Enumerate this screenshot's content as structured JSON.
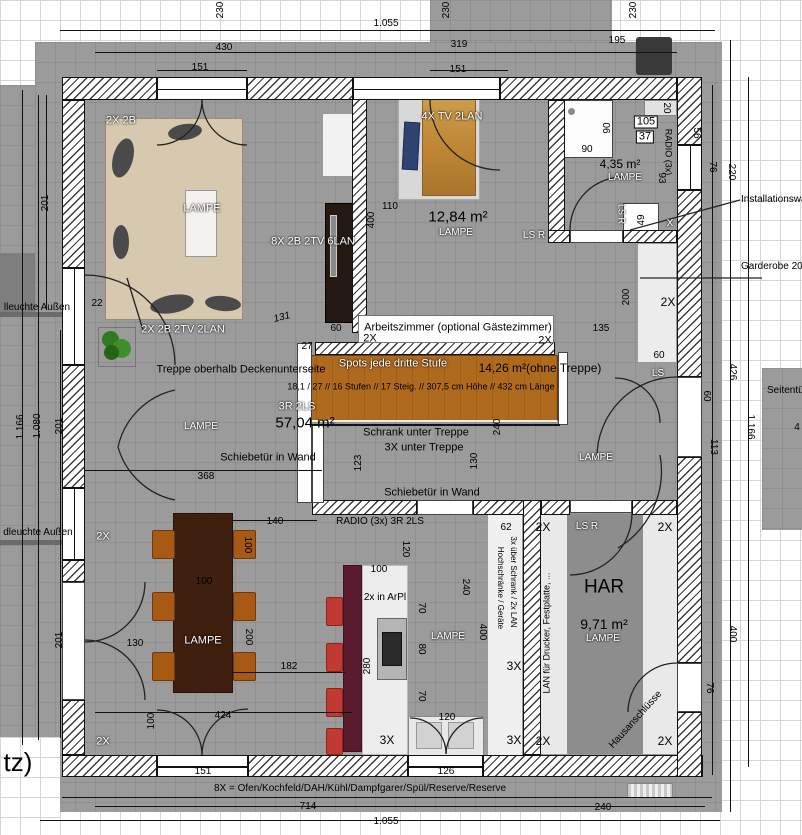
{
  "colors": {
    "ground": "#9b9b9b",
    "wallhatch": "#3a3a3a",
    "stair": "#b06a1e",
    "island": "#5a1b2f",
    "wood": "#bf8534",
    "sofa": "#d6c9b0",
    "table": "#3f1f0d",
    "chair": "#a85a14",
    "stool": "#c13a31",
    "pillow": "#2e4370"
  },
  "plan": {
    "annotations": [
      {
        "t": "1.055",
        "x": 386,
        "y": 24
      },
      {
        "t": "430",
        "x": 224,
        "y": 48
      },
      {
        "t": "151",
        "x": 200,
        "y": 68
      },
      {
        "t": "319",
        "x": 459,
        "y": 45
      },
      {
        "t": "151",
        "x": 458,
        "y": 70
      },
      {
        "t": "195",
        "x": 617,
        "y": 41
      },
      {
        "t": "230",
        "x": 221,
        "y": 10,
        "r": -90
      },
      {
        "t": "230",
        "x": 447,
        "y": 10,
        "r": -90
      },
      {
        "t": "230",
        "x": 634,
        "y": 10,
        "r": -90
      },
      {
        "t": "201",
        "x": 46,
        "y": 203,
        "r": -90
      },
      {
        "t": "1.166",
        "x": 21,
        "y": 427,
        "r": -90
      },
      {
        "t": "1.080",
        "x": 38,
        "y": 426,
        "r": -90
      },
      {
        "t": "201",
        "x": 60,
        "y": 426,
        "r": -90
      },
      {
        "t": "201",
        "x": 60,
        "y": 640,
        "r": -90
      },
      {
        "t": "22",
        "x": 97,
        "y": 304
      },
      {
        "t": "20",
        "x": 666,
        "y": 108,
        "r": 90
      },
      {
        "t": "105",
        "x": 646,
        "y": 122,
        "s": 11,
        "bg": 1
      },
      {
        "t": "37",
        "x": 645,
        "y": 137,
        "s": 11,
        "bg": 1
      },
      {
        "t": "RADIO (3x)",
        "x": 668,
        "y": 152,
        "r": 90,
        "s": 9
      },
      {
        "t": "56",
        "x": 696,
        "y": 133,
        "r": 90
      },
      {
        "t": "93",
        "x": 661,
        "y": 178,
        "r": 90
      },
      {
        "t": "76",
        "x": 712,
        "y": 167,
        "r": 90
      },
      {
        "t": "220",
        "x": 731,
        "y": 172,
        "r": 90
      },
      {
        "t": "49",
        "x": 642,
        "y": 220,
        "r": -90
      },
      {
        "t": "X",
        "x": 670,
        "y": 224,
        "c": "w"
      },
      {
        "t": "60",
        "x": 659,
        "y": 356
      },
      {
        "t": "200",
        "x": 627,
        "y": 297,
        "r": -90
      },
      {
        "t": "135",
        "x": 601,
        "y": 329
      },
      {
        "t": "426",
        "x": 732,
        "y": 372,
        "r": 90
      },
      {
        "t": "60",
        "x": 706,
        "y": 396,
        "r": 90
      },
      {
        "t": "113",
        "x": 713,
        "y": 447,
        "r": 90
      },
      {
        "t": "1.166",
        "x": 750,
        "y": 427,
        "r": 90
      },
      {
        "t": "400",
        "x": 732,
        "y": 634,
        "r": 90
      },
      {
        "t": "76",
        "x": 709,
        "y": 688,
        "r": 90
      },
      {
        "t": "240",
        "x": 603,
        "y": 808
      },
      {
        "t": "151",
        "x": 203,
        "y": 772
      },
      {
        "t": "126",
        "x": 446,
        "y": 772
      },
      {
        "t": "714",
        "x": 308,
        "y": 807
      },
      {
        "t": "1.055",
        "x": 386,
        "y": 822
      },
      {
        "t": "131",
        "x": 282,
        "y": 318,
        "r": -15,
        "i": 1
      },
      {
        "t": "60",
        "x": 336,
        "y": 329
      },
      {
        "t": "27",
        "x": 307,
        "y": 347
      },
      {
        "t": "110",
        "x": 390,
        "y": 207
      },
      {
        "t": "400",
        "x": 372,
        "y": 220,
        "r": -90
      },
      {
        "t": "90",
        "x": 587,
        "y": 150
      },
      {
        "t": "90",
        "x": 608,
        "y": 128,
        "r": -90
      },
      {
        "t": "368",
        "x": 206,
        "y": 477
      },
      {
        "t": "123",
        "x": 359,
        "y": 463,
        "r": -90
      },
      {
        "t": "130",
        "x": 475,
        "y": 461,
        "r": -90
      },
      {
        "t": "240",
        "x": 498,
        "y": 427,
        "r": -90
      },
      {
        "t": "120",
        "x": 405,
        "y": 549,
        "r": 90
      },
      {
        "t": "100",
        "x": 379,
        "y": 570
      },
      {
        "t": "70",
        "x": 421,
        "y": 608,
        "r": 90
      },
      {
        "t": "80",
        "x": 421,
        "y": 649,
        "r": 90
      },
      {
        "t": "70",
        "x": 421,
        "y": 696,
        "r": 90
      },
      {
        "t": "280",
        "x": 368,
        "y": 666,
        "r": -90
      },
      {
        "t": "240",
        "x": 465,
        "y": 587,
        "r": 90
      },
      {
        "t": "400",
        "x": 482,
        "y": 632,
        "r": 90
      },
      {
        "t": "62",
        "x": 506,
        "y": 528
      },
      {
        "t": "120",
        "x": 447,
        "y": 718
      },
      {
        "t": "140",
        "x": 275,
        "y": 522
      },
      {
        "t": "100",
        "x": 247,
        "y": 545,
        "r": 90
      },
      {
        "t": "100",
        "x": 204,
        "y": 582
      },
      {
        "t": "130",
        "x": 135,
        "y": 644
      },
      {
        "t": "200",
        "x": 248,
        "y": 637,
        "r": 90
      },
      {
        "t": "182",
        "x": 289,
        "y": 667
      },
      {
        "t": "424",
        "x": 223,
        "y": 716
      },
      {
        "t": "100",
        "x": 152,
        "y": 721,
        "r": -90
      },
      {
        "t": "Treppe oberhalb Deckenunterseite",
        "x": 241,
        "y": 370,
        "s": 11
      },
      {
        "t": "18,1 / 27 // 16 Stufen // 17 Steig. // 307,5 cm Höhe // 432 cm Länge",
        "x": 421,
        "y": 387,
        "s": 9
      },
      {
        "t": "57,04 m²",
        "x": 305,
        "y": 423,
        "s": 15
      },
      {
        "t": "14,26 m²(ohne Treppe)",
        "x": 540,
        "y": 368,
        "s": 12
      },
      {
        "t": "12,84 m²",
        "x": 458,
        "y": 217,
        "s": 15
      },
      {
        "t": "4,35 m²",
        "x": 620,
        "y": 164,
        "s": 12
      },
      {
        "t": "9,71 m²",
        "x": 604,
        "y": 624,
        "s": 14
      },
      {
        "t": "HAR",
        "x": 604,
        "y": 587,
        "s": 19
      },
      {
        "t": "Arbeitszimmer (optional Gästezimmer)",
        "x": 458,
        "y": 328,
        "s": 11
      },
      {
        "t": "2X",
        "x": 370,
        "y": 339,
        "s": 11
      },
      {
        "t": "2X",
        "x": 545,
        "y": 341,
        "s": 11
      },
      {
        "t": "Schrank unter Treppe",
        "x": 416,
        "y": 433,
        "s": 11
      },
      {
        "t": "3X unter Treppe",
        "x": 424,
        "y": 448,
        "s": 11
      },
      {
        "t": "Schiebetür in Wand",
        "x": 268,
        "y": 458,
        "s": 11
      },
      {
        "t": "Schiebetür in Wand",
        "x": 432,
        "y": 493,
        "s": 11
      },
      {
        "t": "RADIO (3x)  3R 2LS",
        "x": 380,
        "y": 522
      },
      {
        "t": "2x in ArPl",
        "x": 385,
        "y": 598
      },
      {
        "t": "3X",
        "x": 514,
        "y": 666,
        "s": 12
      },
      {
        "t": "3X",
        "x": 387,
        "y": 740,
        "s": 12
      },
      {
        "t": "3X",
        "x": 514,
        "y": 740,
        "s": 12
      },
      {
        "t": "2X",
        "x": 543,
        "y": 527,
        "s": 12
      },
      {
        "t": "2X",
        "x": 665,
        "y": 527,
        "s": 12
      },
      {
        "t": "2X",
        "x": 543,
        "y": 741,
        "s": 12
      },
      {
        "t": "2X",
        "x": 665,
        "y": 741,
        "s": 12
      },
      {
        "t": "2X",
        "x": 668,
        "y": 302,
        "s": 12
      },
      {
        "t": "3x über Schrank / 2x LAN",
        "x": 513,
        "y": 582,
        "r": 90,
        "s": 8
      },
      {
        "t": "Hochschränke / Geräte",
        "x": 500,
        "y": 588,
        "r": 90,
        "s": 8
      },
      {
        "t": "LAN für Drucker, Festplatte, ...",
        "x": 547,
        "y": 633,
        "r": -90,
        "s": 9
      },
      {
        "t": "Hausanschlüsse",
        "x": 636,
        "y": 720,
        "r": -48
      },
      {
        "t": "8X = Ofen/Kochfeld/DAH/Kühl/Dampfgarer/Spül/Reserve/Reserve",
        "x": 360,
        "y": 789
      },
      {
        "t": "tz)",
        "x": 18,
        "y": 762,
        "s": 26
      },
      {
        "t": "lleuchte Außen",
        "x": 37,
        "y": 308
      },
      {
        "t": "dleuchte Außen",
        "x": 38,
        "y": 533
      },
      {
        "t": "Installationswand",
        "x": 741,
        "y": 200,
        "a": "l"
      },
      {
        "t": "Garderobe 200",
        "x": 741,
        "y": 267,
        "a": "l"
      },
      {
        "t": "Seitentür",
        "x": 767,
        "y": 391,
        "a": "l"
      },
      {
        "t": "4",
        "x": 797,
        "y": 428
      },
      {
        "t": "2X 2B",
        "x": 121,
        "y": 121,
        "c": "w",
        "s": 11
      },
      {
        "t": "LAMPE",
        "x": 202,
        "y": 209,
        "c": "w",
        "s": 11
      },
      {
        "t": "8X 2B 2TV 6LAN",
        "x": 313,
        "y": 242,
        "c": "w",
        "s": 11
      },
      {
        "t": "2X 2B 2TV 2LAN",
        "x": 183,
        "y": 330,
        "c": "w",
        "s": 11
      },
      {
        "t": "4X TV 2LAN",
        "x": 452,
        "y": 117,
        "c": "w",
        "s": 11
      },
      {
        "t": "LAMPE",
        "x": 456,
        "y": 233,
        "c": "w"
      },
      {
        "t": "LAMPE",
        "x": 625,
        "y": 178,
        "c": "w"
      },
      {
        "t": "LS R",
        "x": 621,
        "y": 214,
        "c": "w",
        "r": 90,
        "s": 9
      },
      {
        "t": "LS R",
        "x": 534,
        "y": 236,
        "c": "w"
      },
      {
        "t": "Spots jede dritte Stufe",
        "x": 393,
        "y": 364,
        "c": "w",
        "s": 11
      },
      {
        "t": "3R 2LS",
        "x": 297,
        "y": 407,
        "c": "w",
        "s": 11
      },
      {
        "t": "LAMPE",
        "x": 201,
        "y": 427,
        "c": "w"
      },
      {
        "t": "LAMPE",
        "x": 596,
        "y": 458,
        "c": "w"
      },
      {
        "t": "LS",
        "x": 658,
        "y": 374,
        "c": "w"
      },
      {
        "t": "LAMPE",
        "x": 203,
        "y": 641,
        "c": "w",
        "s": 11
      },
      {
        "t": "LAMPE",
        "x": 448,
        "y": 637,
        "c": "w"
      },
      {
        "t": "LAMPE",
        "x": 603,
        "y": 639,
        "c": "w"
      },
      {
        "t": "LS R",
        "x": 587,
        "y": 527,
        "c": "w"
      },
      {
        "t": "2X",
        "x": 103,
        "y": 537,
        "c": "w",
        "s": 11
      },
      {
        "t": "2X",
        "x": 103,
        "y": 742,
        "c": "w",
        "s": 11
      }
    ]
  }
}
